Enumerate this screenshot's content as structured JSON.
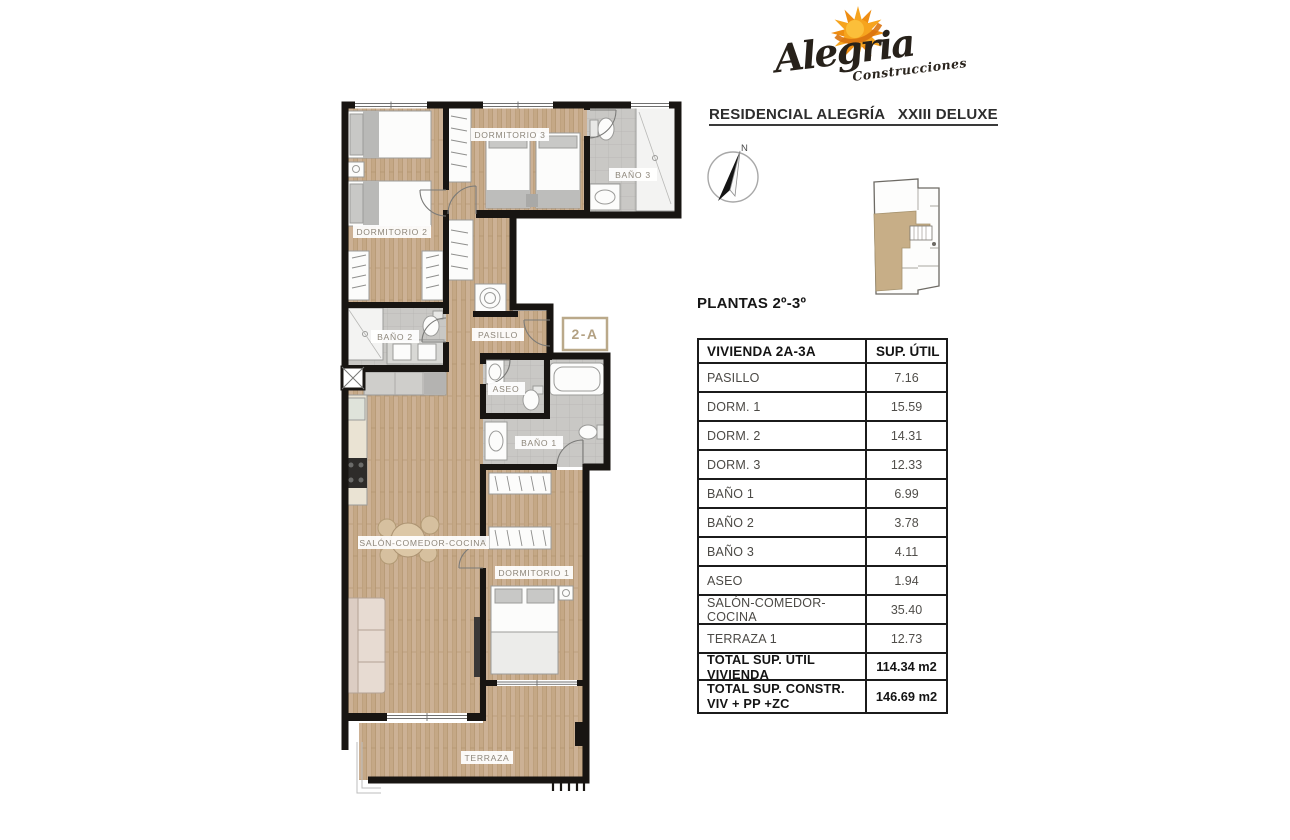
{
  "logo": {
    "brand": "Alegria",
    "subtitle": "Construcciones"
  },
  "header": {
    "title": "RESIDENCIAL ALEGRÍA   XXIII DELUXE"
  },
  "compass": {
    "north_label": "N"
  },
  "section": {
    "floor_label": "PLANTAS 2º-3º"
  },
  "plan": {
    "unit_label": "2-A",
    "room_labels": {
      "dormitorio2": "DORMITORIO 2",
      "dormitorio3": "DORMITORIO 3",
      "bano3": "BAÑO 3",
      "pasillo": "PASILLO",
      "bano2": "BAÑO 2",
      "aseo": "ASEO",
      "bano1": "BAÑO 1",
      "salon": "SALÓN-COMEDOR-COCINA",
      "dormitorio1": "DORMITORIO 1",
      "terraza": "TERRAZA"
    }
  },
  "table": {
    "header": {
      "col1": "VIVIENDA 2A-3A",
      "col2": "SUP. ÚTIL"
    },
    "rows": [
      {
        "label": "PASILLO",
        "value": "7.16"
      },
      {
        "label": "DORM. 1",
        "value": "15.59"
      },
      {
        "label": "DORM. 2",
        "value": "14.31"
      },
      {
        "label": "DORM. 3",
        "value": "12.33"
      },
      {
        "label": "BAÑO 1",
        "value": "6.99"
      },
      {
        "label": "BAÑO 2",
        "value": "3.78"
      },
      {
        "label": "BAÑO 3",
        "value": "4.11"
      },
      {
        "label": "ASEO",
        "value": "1.94"
      },
      {
        "label": "SALÓN-COMEDOR-COCINA",
        "value": "35.40"
      },
      {
        "label": "TERRAZA 1",
        "value": "12.73"
      }
    ],
    "totals": [
      {
        "label": "TOTAL SUP. ÚTIL VIVIENDA",
        "value": "114.34 m2"
      },
      {
        "label_line1": "TOTAL SUP. CONSTR.",
        "label_line2": "VIV + PP +ZC",
        "value": "146.69 m2"
      }
    ]
  },
  "colors": {
    "wall": "#181512",
    "wood": "#ccb195",
    "tile": "#c9c8c5",
    "accent_tan": "#c7ae87",
    "unit_label_tan": "#b3a183",
    "sun_orange": "#f6a41e"
  }
}
